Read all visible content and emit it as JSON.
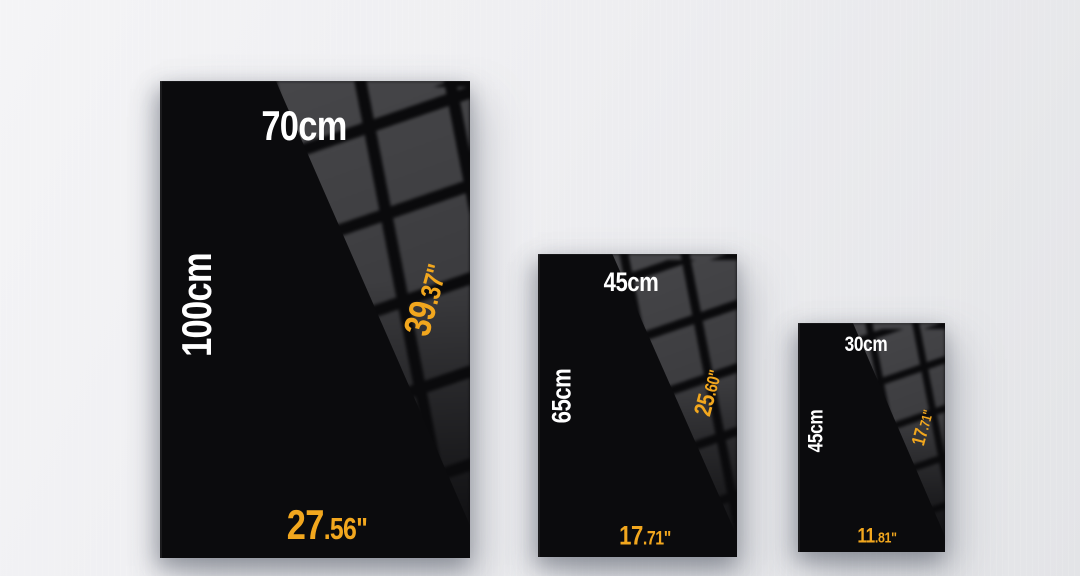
{
  "colors": {
    "accent_orange": "#F2A71E",
    "label_white": "#FFFFFF",
    "poster_black": "#0B0B0D",
    "pattern_gray": "#3B3B3E",
    "wall_light": "#F4F4F6",
    "wall_dark": "#E3E4E7"
  },
  "posters": [
    {
      "name": "70x100cm",
      "width_label": "70cm",
      "height_label": "100cm",
      "height_in_int": "39",
      "height_in_frac": ".37\"",
      "width_in_int": "27",
      "width_in_frac": ".56\""
    },
    {
      "name": "45x65cm",
      "width_label": "45cm",
      "height_label": "65cm",
      "height_in_int": "25",
      "height_in_frac": ".60\"",
      "width_in_int": "17",
      "width_in_frac": ".71\""
    },
    {
      "name": "30x45cm",
      "width_label": "30cm",
      "height_label": "45cm",
      "height_in_int": "17",
      "height_in_frac": ".71\"",
      "width_in_int": "11",
      "width_in_frac": ".81\""
    }
  ]
}
